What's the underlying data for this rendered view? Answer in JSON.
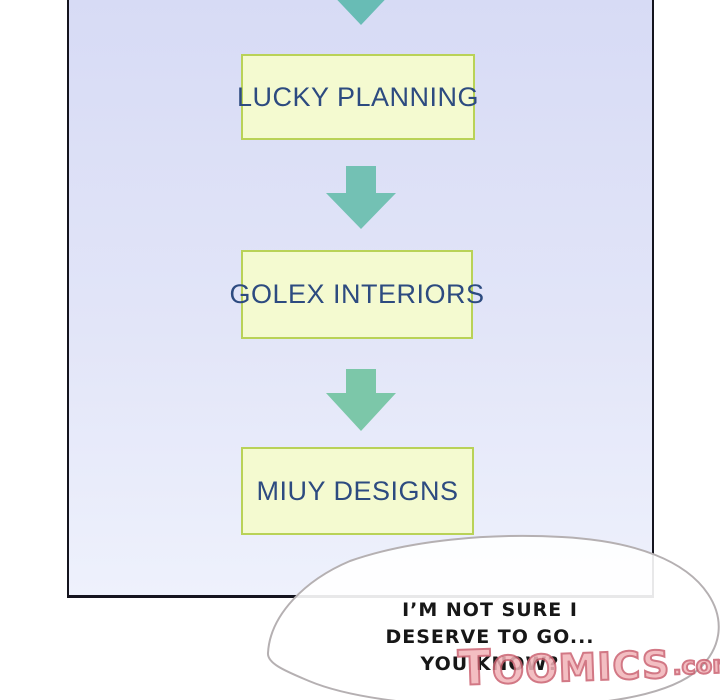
{
  "panel": {
    "type": "comic-panel",
    "description": "flowchart of company names on lavender gradient, cut off at top"
  },
  "flowchart": {
    "nodes": [
      {
        "id": "lucky-planning",
        "label": "LUCKY PLANNING"
      },
      {
        "id": "golex-interiors",
        "label": "GOLEX INTERIORS"
      },
      {
        "id": "miuy-designs",
        "label": "MIUY DESIGNS"
      }
    ],
    "connector": "down-arrow"
  },
  "speech_bubble": {
    "lines": {
      "0": "I’M  NOT SURE I",
      "1": "DESERVE TO GO...",
      "2": "YOU KNOW?"
    }
  },
  "watermark": {
    "brand": "TOOMICS",
    "suffix": ".com"
  },
  "colors": {
    "panel_border": "#14141e",
    "bg_top": "#d7dbf5",
    "bg_mid": "#e2e5f8",
    "bg_bottom": "#eef1fc",
    "box_fill": "#f4fad0",
    "box_border": "#b9d257",
    "box_text": "#2d4b80",
    "arrow_1": "#68bcb5",
    "arrow_2": "#73c1b4",
    "arrow_3": "#7cc7a9",
    "bubble_fill": "#ffffff",
    "bubble_stroke": "#b5b0b2",
    "bubble_text": "#171717",
    "wm_fill": "#f2b3b8",
    "wm_stroke": "#cb6170"
  }
}
